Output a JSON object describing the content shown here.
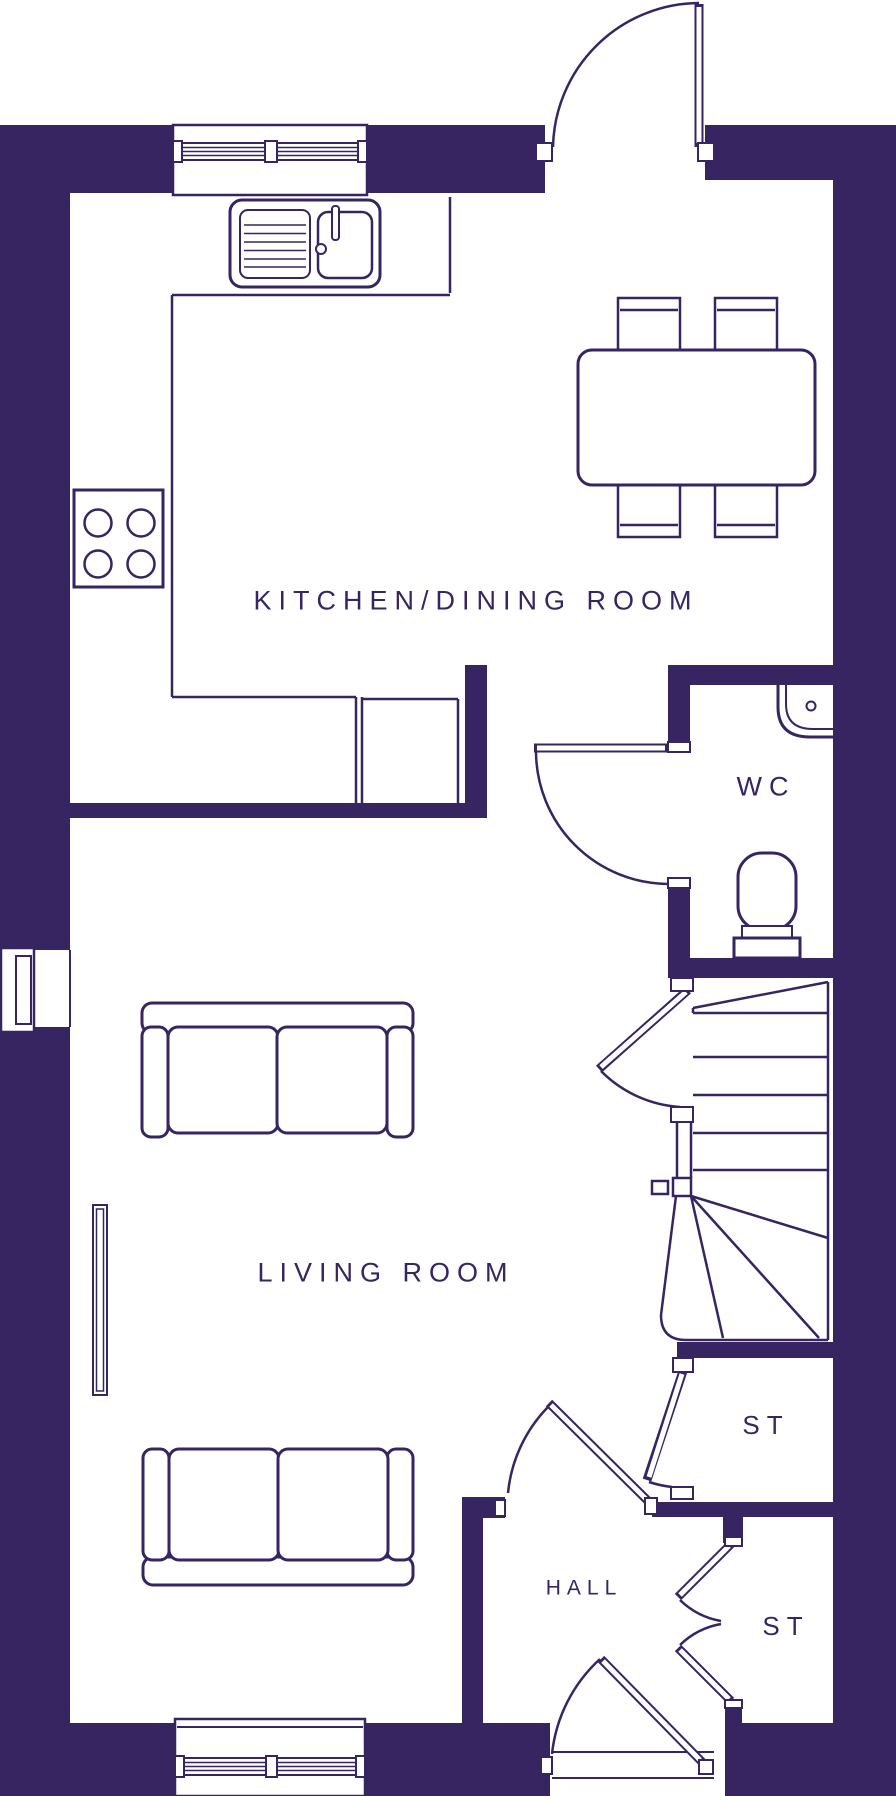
{
  "title": "Ground floor plan",
  "colors": {
    "wall": "#362561",
    "background": "#ffffff",
    "line": "#362561",
    "text": "#362561"
  },
  "rooms": {
    "kitchen_dining": {
      "label": "KITCHEN/DINING ROOM"
    },
    "wc": {
      "label": "WC"
    },
    "living_room": {
      "label": "LIVING ROOM"
    },
    "storage_1": {
      "label": "ST"
    },
    "hall": {
      "label": "HALL"
    },
    "storage_2": {
      "label": "ST"
    }
  },
  "fixtures": [
    "kitchen-sink-with-drainer",
    "hob-4-rings",
    "kitchen-worktop",
    "dining-table",
    "dining-chairs-x4",
    "wc-basin",
    "wc-toilet",
    "sofa-large",
    "sofa-large",
    "radiator",
    "flue",
    "staircase-with-winders",
    "window-top",
    "window-bottom",
    "back-door",
    "wc-door",
    "living-room-door",
    "hall-door",
    "storage-door",
    "storage-double-doors",
    "front-door"
  ]
}
